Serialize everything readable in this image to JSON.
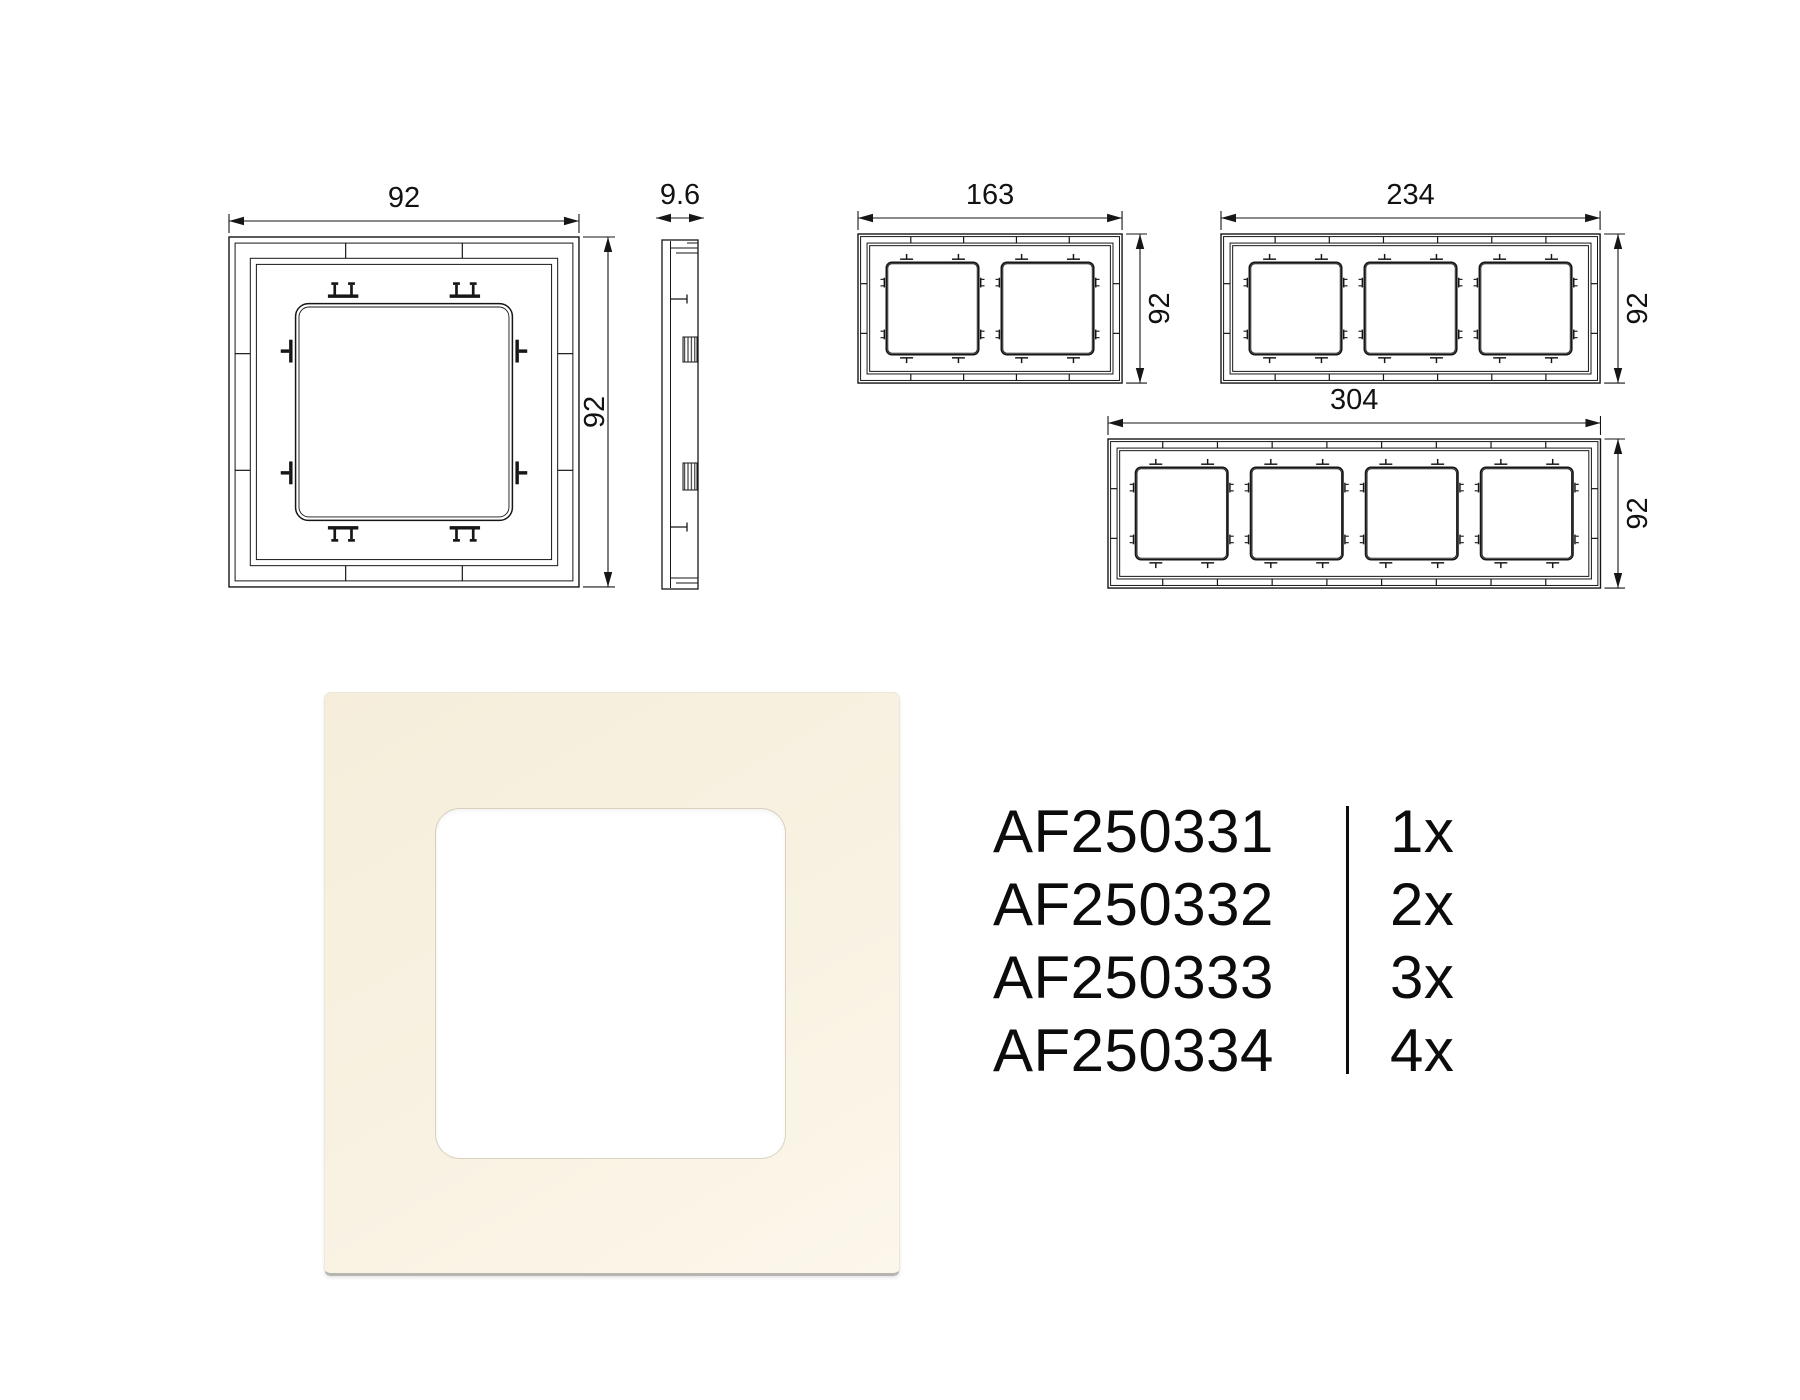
{
  "sheet": {
    "background": "#ffffff",
    "line_color": "#161616",
    "text_color": "#0c0c0c"
  },
  "dims": {
    "one_gang": {
      "width": "92",
      "height": "92"
    },
    "side_profile": {
      "depth": "9.6"
    },
    "two_gang": {
      "width": "163",
      "height": "92"
    },
    "three_gang": {
      "width": "234",
      "height": "92"
    },
    "four_gang": {
      "width": "304",
      "height": "92"
    }
  },
  "product": {
    "frame_color": "#f8f1e1",
    "window_color": "#ffffff"
  },
  "product_codes": [
    {
      "code": "AF250331",
      "quantity": "1x"
    },
    {
      "code": "AF250332",
      "quantity": "2x"
    },
    {
      "code": "AF250333",
      "quantity": "3x"
    },
    {
      "code": "AF250334",
      "quantity": "4x"
    }
  ]
}
